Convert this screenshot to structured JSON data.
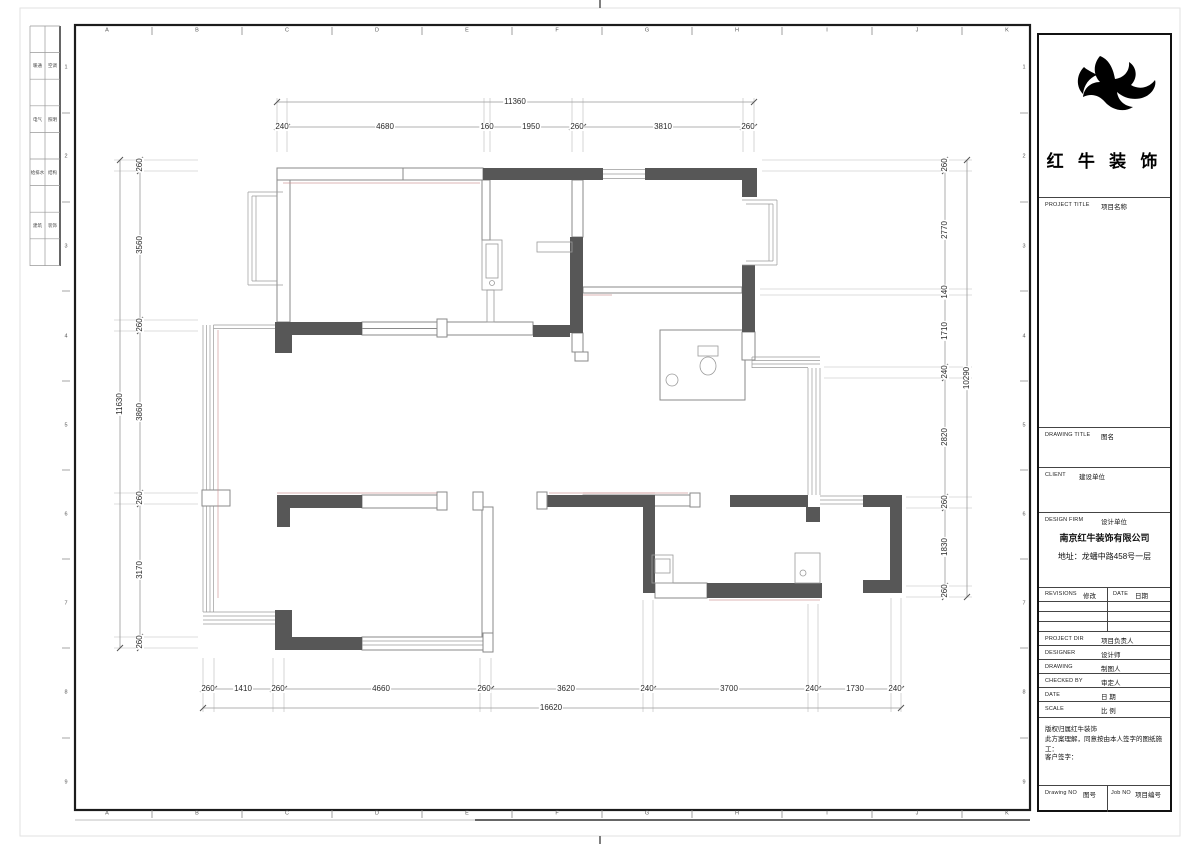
{
  "sheet": {
    "grid_letters": [
      "A",
      "B",
      "C",
      "D",
      "E",
      "F",
      "G",
      "H",
      "I",
      "J",
      "K"
    ],
    "grid_numbers": [
      "1",
      "2",
      "3",
      "4",
      "5",
      "6",
      "7",
      "8",
      "9"
    ],
    "margin_table": {
      "rows": [
        [
          "暖通",
          "空调"
        ],
        [
          "电气",
          "照明"
        ],
        [
          "给排水",
          "结构"
        ],
        [
          "建筑",
          "装饰"
        ]
      ]
    }
  },
  "title_block": {
    "brand_name": "红 牛 装 饰",
    "project_title_en": "PROJECT TITLE",
    "project_title_cn": "项目名称",
    "drawing_title_en": "DRAWING TITLE",
    "drawing_title_cn": "图名",
    "client_en": "CLIENT",
    "client_cn": "建设单位",
    "design_firm_en": "DESIGN FIRM",
    "design_firm_cn": "设计单位",
    "company_name": "南京红牛装饰有限公司",
    "company_address": "地址：龙蟠中路458号一层",
    "revisions_en": "REVISIONS",
    "revisions_cn": "修改",
    "date_col_en": "DATE",
    "date_col_cn": "日期",
    "rows": [
      {
        "en": "PROJECT DIR",
        "cn": "项目负责人"
      },
      {
        "en": "DESIGNER",
        "cn": "设计师"
      },
      {
        "en": "DRAWING",
        "cn": "制图人"
      },
      {
        "en": "CHECKED BY",
        "cn": "审定人"
      },
      {
        "en": "DATE",
        "cn": "日  期"
      },
      {
        "en": "SCALE",
        "cn": "比  例"
      }
    ],
    "copyright_line1": "版权归属红牛装饰",
    "copyright_line2": "此方案理解，同意按由本人签字的图纸施工：",
    "copyright_line3": "客户签字：",
    "drawing_no_en": "Drawing NO",
    "drawing_no_cn": "图号",
    "job_no_en": "Job NO",
    "job_no_cn": "项目编号"
  },
  "dimensions": {
    "top": {
      "overall": "11360",
      "segments": [
        "240",
        "4680",
        "160",
        "1950",
        "260",
        "3810",
        "260"
      ]
    },
    "bottom": {
      "overall": "16620",
      "segments": [
        "260",
        "1410",
        "260",
        "4660",
        "260",
        "3620",
        "240",
        "3700",
        "240",
        "1730",
        "240"
      ]
    },
    "left": {
      "overall": "11630",
      "segments": [
        "260",
        "3560",
        "260",
        "3860",
        "260",
        "3170",
        "260"
      ]
    },
    "right": {
      "overall": "10290",
      "segments": [
        "260",
        "2770",
        "140",
        "1710",
        "240",
        "2820",
        "260",
        "1830",
        "260"
      ]
    }
  }
}
